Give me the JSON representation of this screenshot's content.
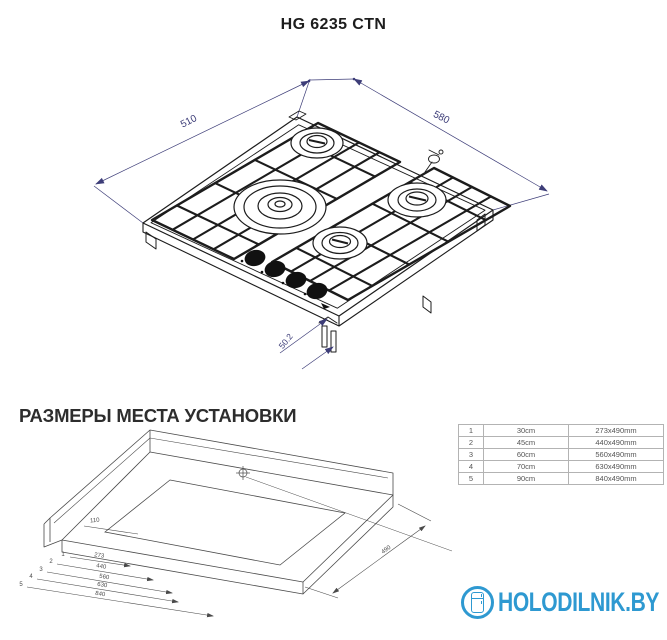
{
  "title": "HG 6235 CTN",
  "cooktop_drawing": {
    "width_mm": "510",
    "depth_mm": "580",
    "height_mm": "50.2"
  },
  "installation": {
    "heading": "РАЗМЕРЫ МЕСТА УСТАНОВКИ",
    "table_rows": [
      {
        "num": "1",
        "size": "30cm",
        "niche": "273x490mm"
      },
      {
        "num": "2",
        "size": "45cm",
        "niche": "440x490mm"
      },
      {
        "num": "3",
        "size": "60cm",
        "niche": "560x490mm"
      },
      {
        "num": "4",
        "size": "70cm",
        "niche": "630x490mm"
      },
      {
        "num": "5",
        "size": "90cm",
        "niche": "840x490mm"
      }
    ],
    "diagram": {
      "edge_offset": "110",
      "depth": "490",
      "width_marks": [
        {
          "num": "1",
          "value": "273"
        },
        {
          "num": "2",
          "value": "440"
        },
        {
          "num": "3",
          "value": "560"
        },
        {
          "num": "4",
          "value": "630"
        },
        {
          "num": "5",
          "value": "840"
        }
      ]
    }
  },
  "watermark": {
    "text": "HOLODILNIK.BY"
  },
  "colors": {
    "accent_blue": "#2e99d1",
    "dimension_navy": "#3d3d78"
  }
}
